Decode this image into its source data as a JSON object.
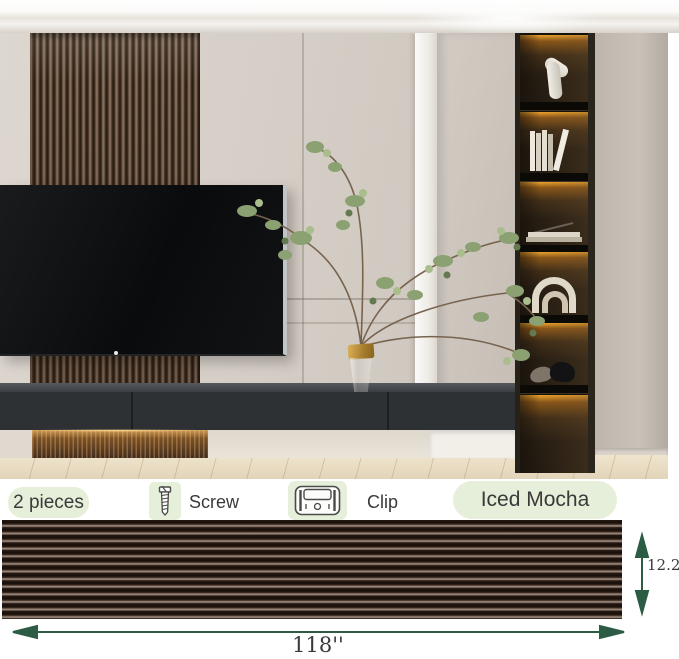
{
  "photo": {
    "alt": "Modern living room with walnut slat accent wall behind a wall-mounted TV, floating dark media console with under-lighting, green branches in a gold-rimmed glass vase, beige cabinetry and a tall shelf tower with amber LED-lit niches holding a sculpture, books, decor rings and elephant figurines"
  },
  "info": {
    "pieces_label": "2 pieces",
    "screw_label": "Screw",
    "clip_label": "Clip",
    "color_name": "Iced Mocha"
  },
  "dimensions": {
    "width_label": "118''",
    "height_label": "12.2''"
  },
  "icons": {
    "screw": "screw-icon",
    "clip": "clip-icon"
  },
  "colors": {
    "badge_green": "#e6efda",
    "arrow_green": "#2d5c44",
    "slat_dark": "#241812",
    "slat_highlight": "#a3907f",
    "label_text": "#3a3a3a"
  }
}
